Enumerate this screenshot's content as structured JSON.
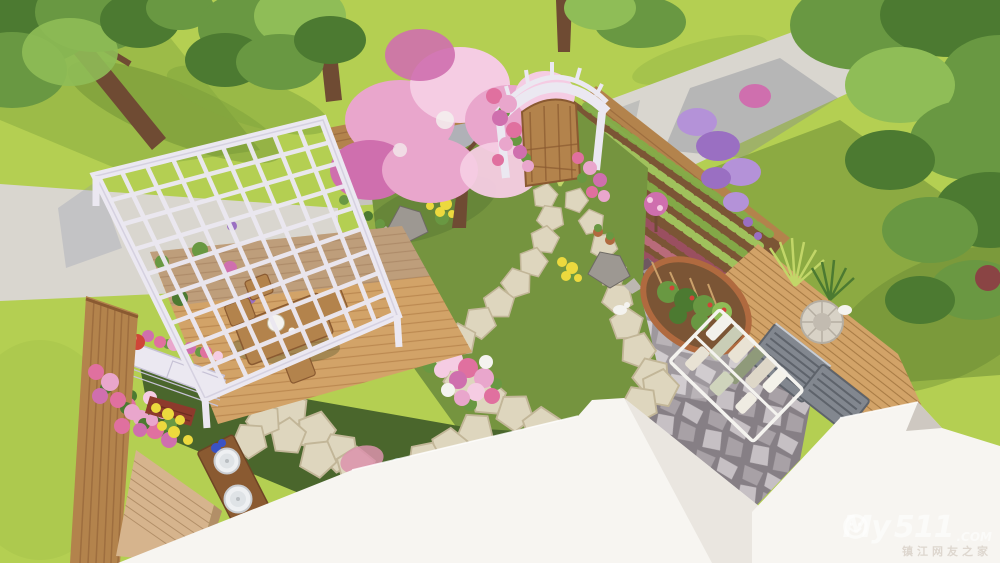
{
  "watermark": {
    "brand_prefix": "My",
    "brand_zero": "0",
    "brand_suffix": "511",
    "tld": ".COM",
    "tagline": "镇江网友之家"
  },
  "icons": {
    "watermark_zero": "smiley-face-icon"
  },
  "palette": {
    "lawn_bright": "#b4cf52",
    "lawn_shadow": "#84a83e",
    "lawn_dark": "#5c7d2f",
    "turf_olive": "#75943f",
    "turf_dark": "#4a662c",
    "concrete": "#d9d6cf",
    "concrete_shade": "#c6c3bd",
    "shadow_blue": "#8d93ae",
    "wood_light": "#d2a368",
    "wood_mid": "#b3834c",
    "wood_dark": "#8a5a31",
    "soil": "#7b5535",
    "stake": "#caa06a",
    "pergola_white": "#ebe8f1",
    "pergola_shade": "#c7c2d6",
    "stone_beige": "#ded6be",
    "stone_edge": "#c2b698",
    "flagstone": "#a8a1a6",
    "flagstone_light": "#c6c0c4",
    "flagstone_grout": "#867f85",
    "plum": "#6f5761",
    "roof_white": "#f7f5f1",
    "roof_shade": "#e4dfd8",
    "roof_dark": "#c9c3bb",
    "brick": "#d6b48d",
    "brick_line": "#b28f68",
    "masonry": "#8d3a2c",
    "leaf_dark": "#4c7a31",
    "leaf_mid": "#699842",
    "leaf_light": "#8fbd57",
    "grass_blade": "#c2d668",
    "trunk": "#6f4b33",
    "blossom": "#e9a6cc",
    "blossom_light": "#f5cce3",
    "blossom_deep": "#cf6fae",
    "rose": "#e0709f",
    "purple": "#9a6fc2",
    "wisteria": "#b492d8",
    "blue_flower": "#3a53c5",
    "yellow_flower": "#ecd93e",
    "pink_grass": "#dc93ad",
    "teal_leaf": "#7fae9a",
    "terracotta": "#b06a3f",
    "red_flower": "#cf4538",
    "ac_gray": "#82878f",
    "ac_dark": "#5e636b",
    "gray_rock": "#9d9892",
    "gray_rock_light": "#bcb7b0",
    "white_soft": "#f4f3ef",
    "veg_green": "#84ad48",
    "veg_green2": "#a3c75f",
    "veg_red": "#9c4f63",
    "veg_red2": "#bd6d7e"
  }
}
